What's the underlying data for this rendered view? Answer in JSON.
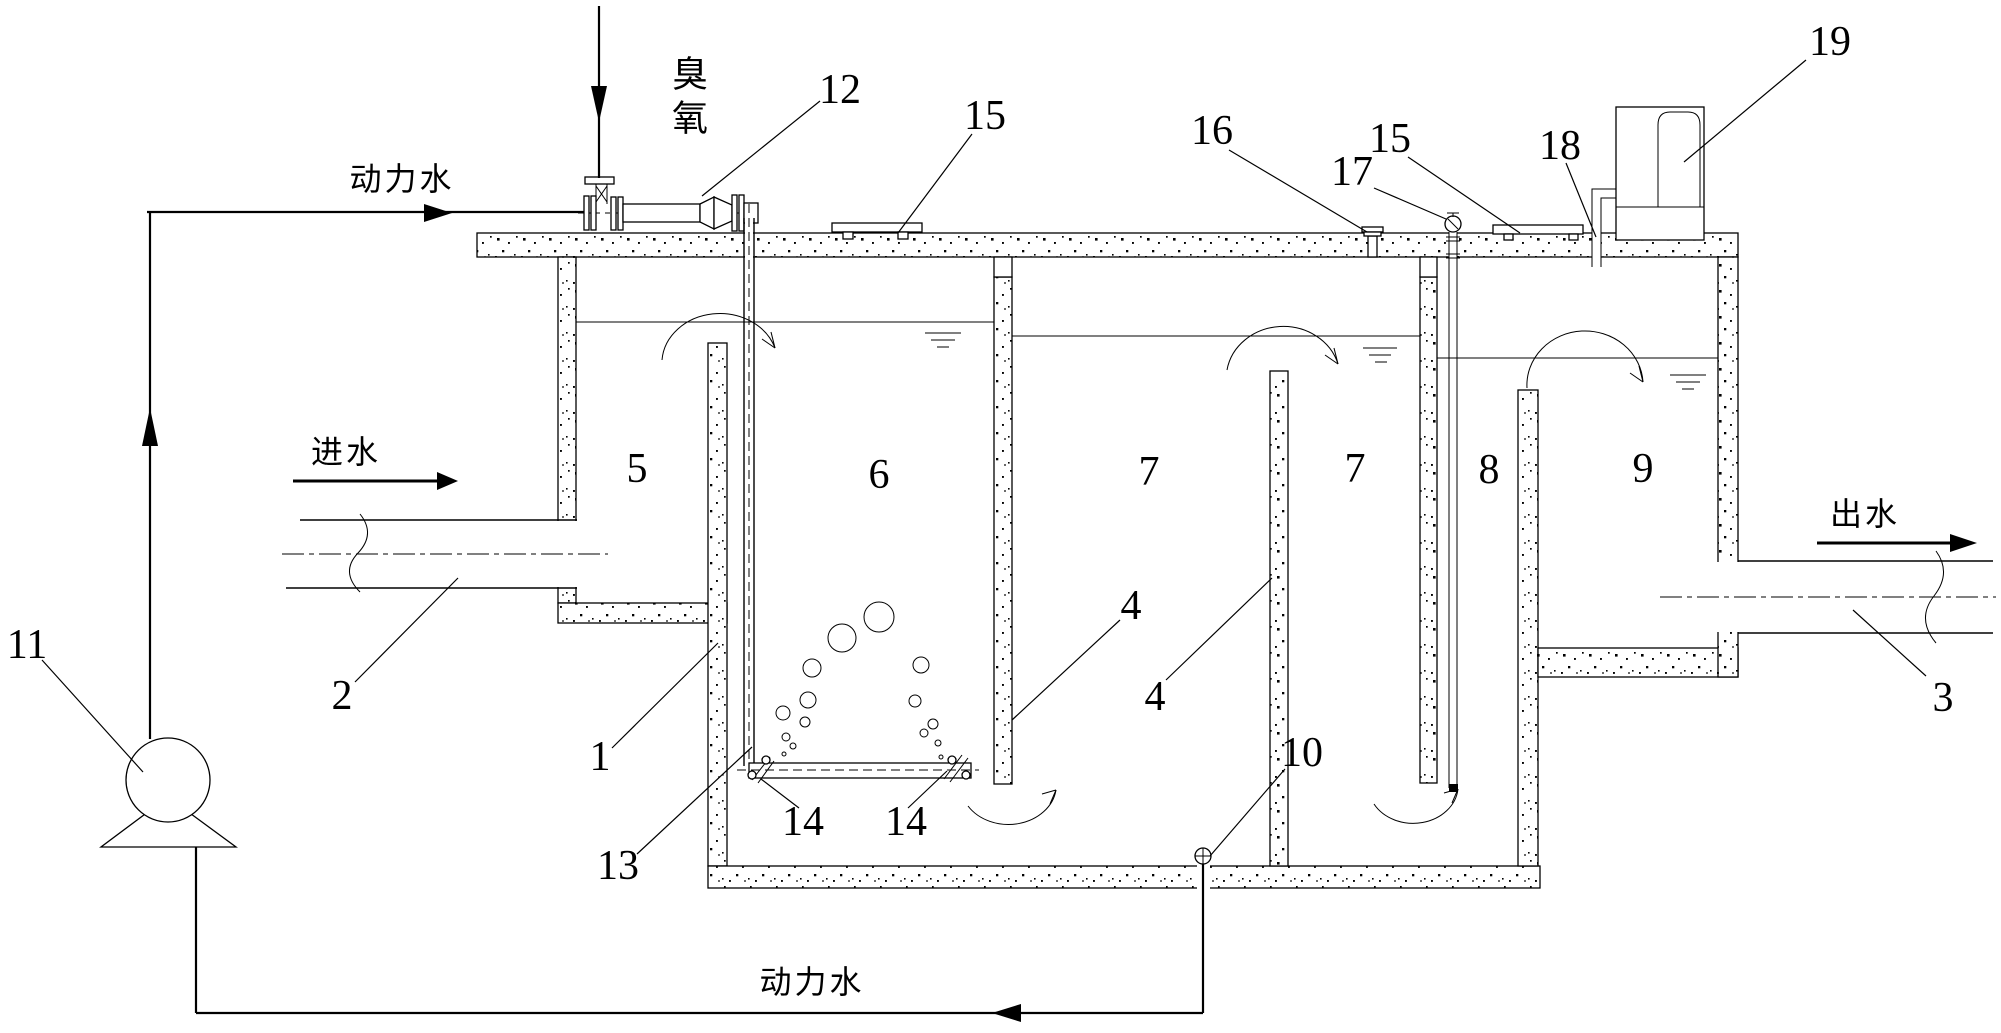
{
  "figure": {
    "kind": "sectional diagram of multi-chamber ozone water treatment tank",
    "background": "#ffffff",
    "ink": "#000000"
  },
  "annotations": {
    "ozone": "臭氧",
    "power_water_top": "动力水",
    "power_water_bottom": "动力水",
    "inlet_water": "进水",
    "outlet_water": "出水"
  },
  "labels": {
    "n1": "1",
    "n2": "2",
    "n3": "3",
    "n4a": "4",
    "n4b": "4",
    "n5": "5",
    "n6": "6",
    "n7a": "7",
    "n7b": "7",
    "n8": "8",
    "n9": "9",
    "n10": "10",
    "n11": "11",
    "n12": "12",
    "n13": "13",
    "n14a": "14",
    "n14b": "14",
    "n15a": "15",
    "n15b": "15",
    "n16": "16",
    "n17": "17",
    "n18": "18",
    "n19": "19"
  }
}
